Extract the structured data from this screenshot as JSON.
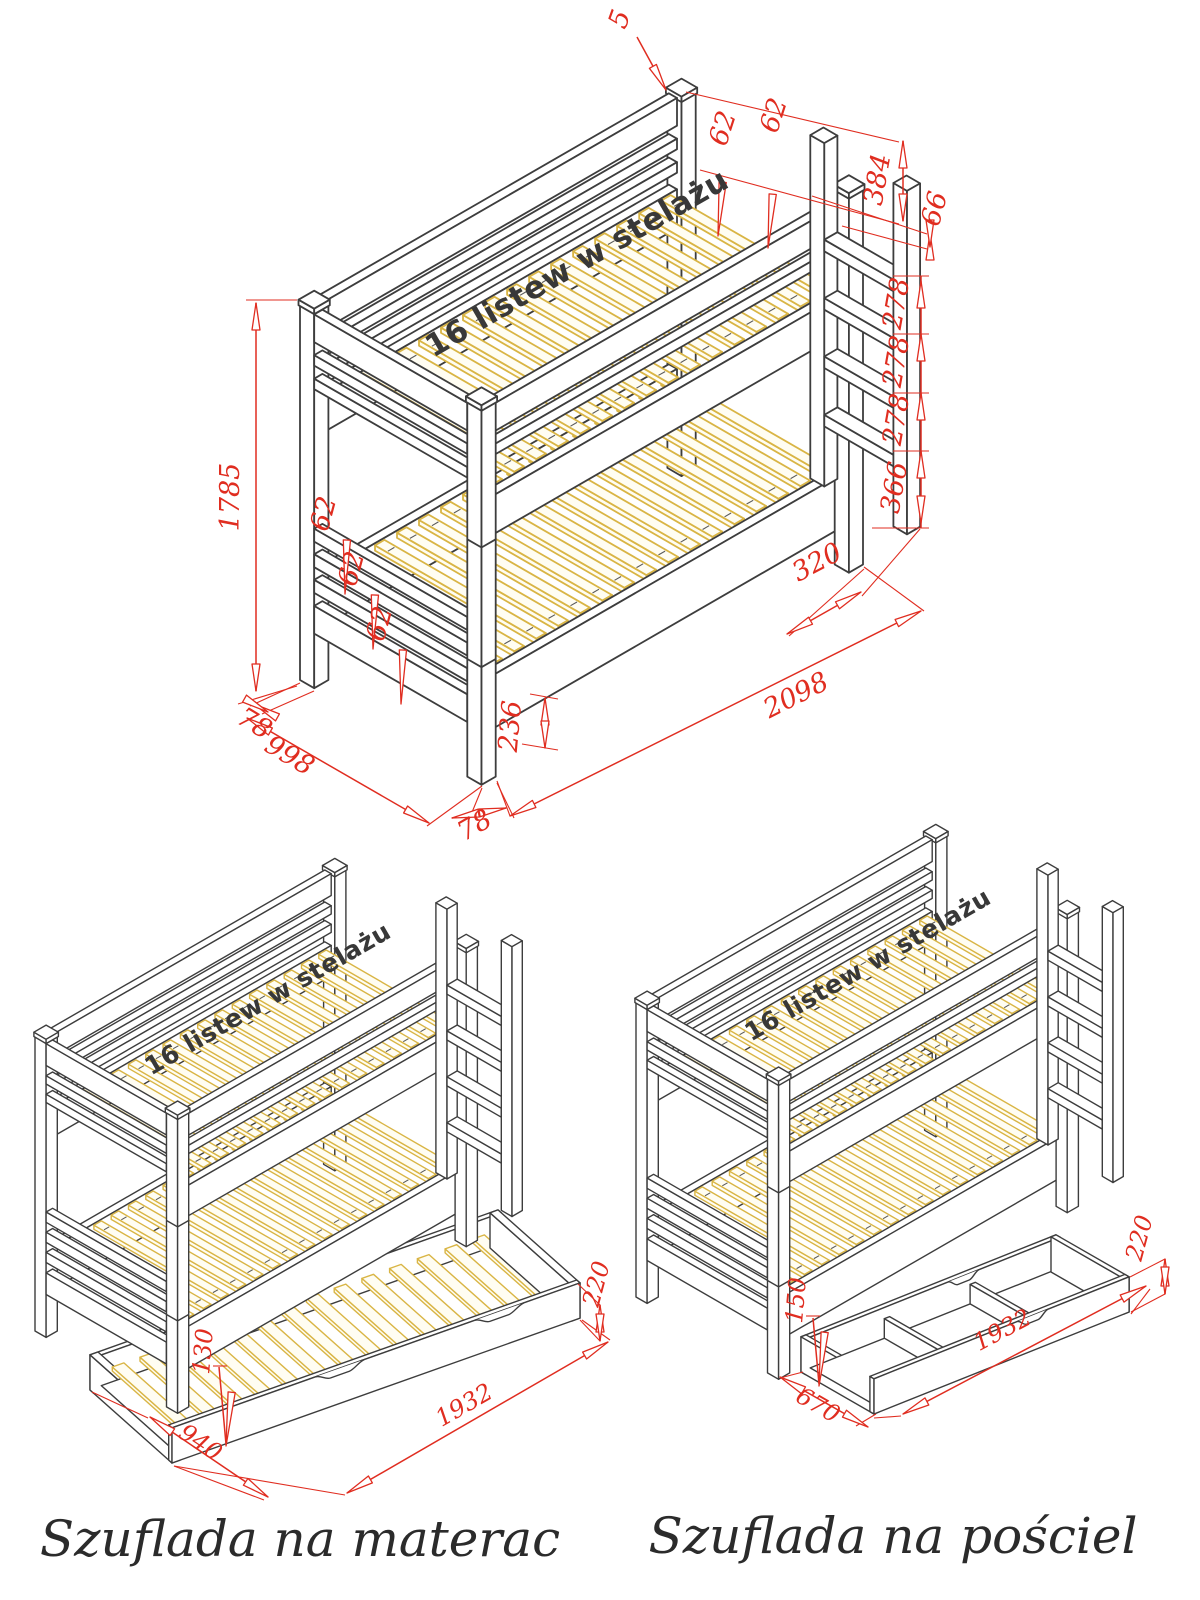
{
  "colors": {
    "background": "#ffffff",
    "outline": "#3d3d3d",
    "slat": "#d9b545",
    "dimension": "#e02d20",
    "label_text": "#383838",
    "caption_text": "#2b2b2b"
  },
  "views": {
    "main": {
      "slat_label": "16 listew w stelażu",
      "dims": {
        "post_cap": "5",
        "rear_gap_a": "62",
        "rear_gap_b": "62",
        "head_top": "384",
        "rung_top_offset": "66",
        "rung_gap_1": "278",
        "rung_gap_2": "278",
        "rung_gap_3": "278",
        "ladder_bottom": "366",
        "ladder_depth": "320",
        "length": "2098",
        "front_post_width": "78",
        "front_rail_bottom": "236",
        "width": "998",
        "side_post_width": "78",
        "height": "1785",
        "head_gap_a": "62",
        "head_gap_b": "62",
        "head_gap_c": "62"
      }
    },
    "mattress": {
      "slat_label": "16 listew w stelażu",
      "caption": "Szuflada na materac",
      "dims": {
        "slat_height": "130",
        "width": "940",
        "length": "1932",
        "front_height": "220"
      }
    },
    "bedding": {
      "slat_label": "16 listew w stelażu",
      "caption": "Szuflada na pościel",
      "dims": {
        "inner_height": "150",
        "width": "670",
        "length": "1932",
        "front_height": "220"
      }
    }
  }
}
